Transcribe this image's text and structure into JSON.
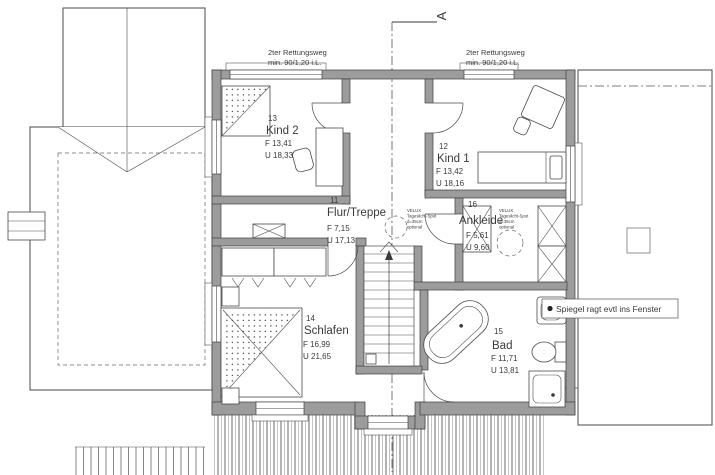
{
  "drawing": {
    "section_marker": {
      "label": "A"
    },
    "escape_route_left": {
      "line1": "2ter Rettungsweg",
      "line2": "min. 90/1,20 i.L."
    },
    "escape_route_right": {
      "line1": "2ter Rettungsweg",
      "line2": "min. 90/1,20 i.L."
    },
    "mirror_note": "Spiegel ragt evtl ins Fenster",
    "velux_note": {
      "line1": "VELUX",
      "line2": "Tageslicht-Spot",
      "line3": "d=35cm",
      "line4": "optional"
    },
    "rooms": [
      {
        "number": "13",
        "name": "Kind 2",
        "area": "F 13,41",
        "perimeter": "U 18,33"
      },
      {
        "number": "12",
        "name": "Kind 1",
        "area": "F 13,42",
        "perimeter": "U 18,16"
      },
      {
        "number": "11",
        "name": "Flur/Treppe",
        "area": "F 7,15",
        "perimeter": "U 17,13"
      },
      {
        "number": "16",
        "name": "Ankleide",
        "area": "F 5,61",
        "perimeter": "U 9,60"
      },
      {
        "number": "14",
        "name": "Schlafen",
        "area": "F 16,99",
        "perimeter": "U 21,65"
      },
      {
        "number": "15",
        "name": "Bad",
        "area": "F 11,71",
        "perimeter": "U 13,81"
      }
    ],
    "colors": {
      "wall": "#9c9c9c",
      "line": "#3f3f3f",
      "hatch": "#787878",
      "background": "#ffffff"
    }
  }
}
